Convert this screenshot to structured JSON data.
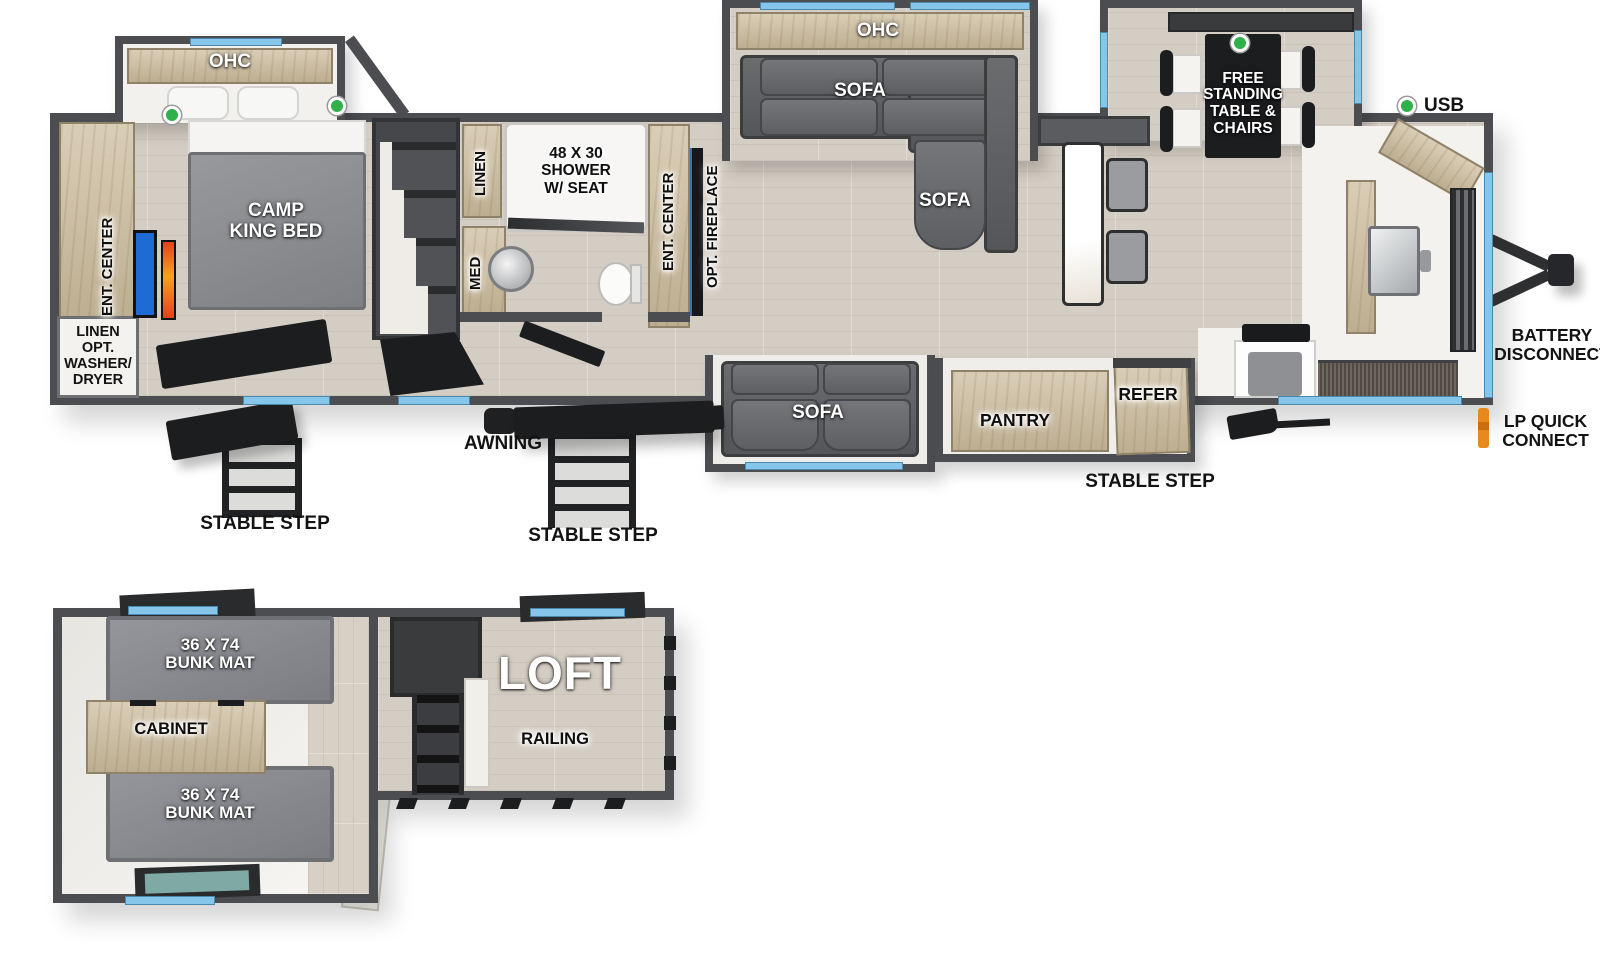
{
  "labels": {
    "bedroom_ohc": "OHC",
    "camp_king_bed": "CAMP\nKING BED",
    "bedroom_ent_center": "ENT. CENTER",
    "linen_opt_washer_dryer": "LINEN\nOPT.\nWASHER/\nDRYER",
    "stable_step_rear": "STABLE STEP",
    "linen": "LINEN",
    "med": "MED",
    "shower": "48 X 30\nSHOWER\nW/ SEAT",
    "bath_ent_center": "ENT. CENTER",
    "opt_fireplace": "OPT. FIREPLACE",
    "awning": "AWNING",
    "stable_step_main": "STABLE STEP",
    "living_ohc": "OHC",
    "sofa_slide": "SOFA",
    "sofa_chaise": "SOFA",
    "dinette": "FREE\nSTANDING\nTABLE &\nCHAIRS",
    "usb": "USB",
    "battery_disconnect": "BATTERY\nDISCONNECT",
    "lp_quick_connect": "LP QUICK\nCONNECT",
    "sofa_door_side": "SOFA",
    "pantry": "PANTRY",
    "refer": "REFER",
    "stable_step_front": "STABLE STEP",
    "bunk_mat_top": "36 X 74\nBUNK MAT",
    "cabinet": "CABINET",
    "bunk_mat_bottom": "36 X 74\nBUNK MAT",
    "loft": "LOFT",
    "railing": "RAILING"
  },
  "colors": {
    "wall_gray": "#4c4d50",
    "floor_wood": "#d4cdc3",
    "cabinet_wood": "#cdbd9e",
    "window_blue": "#85c6ea",
    "led_green": "#2fb04a",
    "lp_orange": "#e8891d",
    "sofa_gray": "#5f6163",
    "bunk_mat_gray": "#8f9196",
    "tv_blue": "#1e6bd6",
    "fireplace_orange": "#f47920"
  }
}
